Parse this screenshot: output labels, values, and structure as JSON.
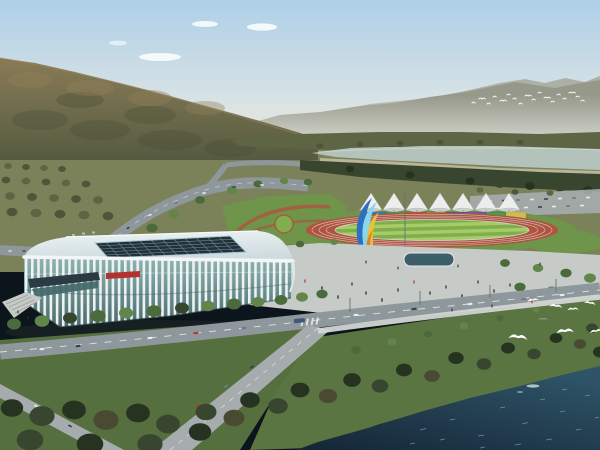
{
  "meta": {
    "type": "architectural-rendering",
    "description": "Aerial rendering of a riverside sports complex: white ribbed arena, outdoor running track with canopy tents and rainbow banner wall, ribbon sculpture, plaza with pedestrians, boulevard traffic, forested hills, river and flying egrets",
    "width": 600,
    "height": 450
  },
  "scene": {
    "background": [
      "hazy layered mountain ridges",
      "forested olive-brown hillside",
      "pale river band",
      "distant bird flock"
    ],
    "midground": [
      "running track with striped infield",
      "seven white canopy tents",
      "rainbow banner wall",
      "colorful ribbon sculpture",
      "white finned stadium arena with glass curtain wall and dark roof skylight",
      "plaza with reflecting pool and pedestrians",
      "parking rows with cars"
    ],
    "foreground": [
      "tree-lined boulevard with traffic",
      "grass embankment and promenade",
      "dense dark shoreline trees",
      "dark teal river water with sparkles",
      "white egrets in flight"
    ]
  },
  "sports_park": {
    "tent_count": 7,
    "banner_colors": [
      "#3a76b4",
      "#4c9a50",
      "#c05440",
      "#cf8a3e",
      "#3a64ac",
      "#7a57a4",
      "#4c9a50",
      "#d3bb4e"
    ],
    "track_color": "#b0543d"
  },
  "wildlife": {
    "foreground_egrets": 8,
    "distant_flock_count": 18
  },
  "palette": {
    "sky_top": "#aecfe8",
    "sky_horizon": "#e8eae4",
    "cloud_white": "#ffffff",
    "ridge_far": "#96988a",
    "ridge_farther": "#a9ab9e",
    "haze": "#dfe2da",
    "hill_top": "#8a7a55",
    "hill_mid": "#6f6c4c",
    "hill_dark": "#565a40",
    "hill_patch_light": "#93805a",
    "hill_patch_dark": "#4c5038",
    "river": "#b3c2ba",
    "river_edge": "#cdd8d0",
    "sand": "#c9c2a8",
    "tree_olive": "#5d6544",
    "tree_olive_dark": "#4d5639",
    "tree_green": "#4c6b3c",
    "tree_green_light": "#62854a",
    "tree_dark": "#39462f",
    "tree_deep": "#263321",
    "tree_brown": "#4a4a33",
    "field": "#7b8159",
    "lawn": "#6e9549",
    "stripe_light": "#a9cb66",
    "stripe_dark": "#7fae4e",
    "track_red": "#b0543d",
    "track_line": "#dadada",
    "path_red": "#a85a40",
    "road": "#8e979b",
    "road_light": "#a6acae",
    "lane_white": "#f0f0f0",
    "plaza": "#c7cbc8",
    "pavement": "#d3d6d3",
    "pool": "#3d5f6a",
    "stadium_white": "#eef2f2",
    "roof_light": "#edf3f4",
    "roof_shade": "#cfdcdf",
    "skylight": "#223039",
    "skylight_grid": "#73959f",
    "glass_teal": "#8fb4b2",
    "glass_dark": "#476a6c",
    "canopy_dark": "#2c3a44",
    "accent_red": "#b23230",
    "tent_white": "#eceeee",
    "tent_shade": "#c9cdcd",
    "sculpture_blue": "#2f6fc1",
    "sculpture_cyan": "#86d8ea",
    "sculpture_yellow": "#e9c23c",
    "sculpture_orange": "#d9802e",
    "sculpture_base": "#3b4040",
    "grass_bank": "#5a7542",
    "grass_left": "#566f3e",
    "water_light": "#2f5468",
    "water_dark": "#142635",
    "sparkle": "#9fc3cf",
    "bird_white": "#ffffff",
    "bird_gray": "#8c9894",
    "car_white": "#e9ecec",
    "car_dark": "#39414a",
    "car_gray": "#707a84",
    "car_red": "#b5382e",
    "bus_blue": "#3d5878",
    "people": "#2f3338",
    "pole_gray": "#6a7072",
    "steps": "#c6cac6",
    "step_line": "#9aa09a",
    "ac_gray": "#b9c4c6"
  }
}
